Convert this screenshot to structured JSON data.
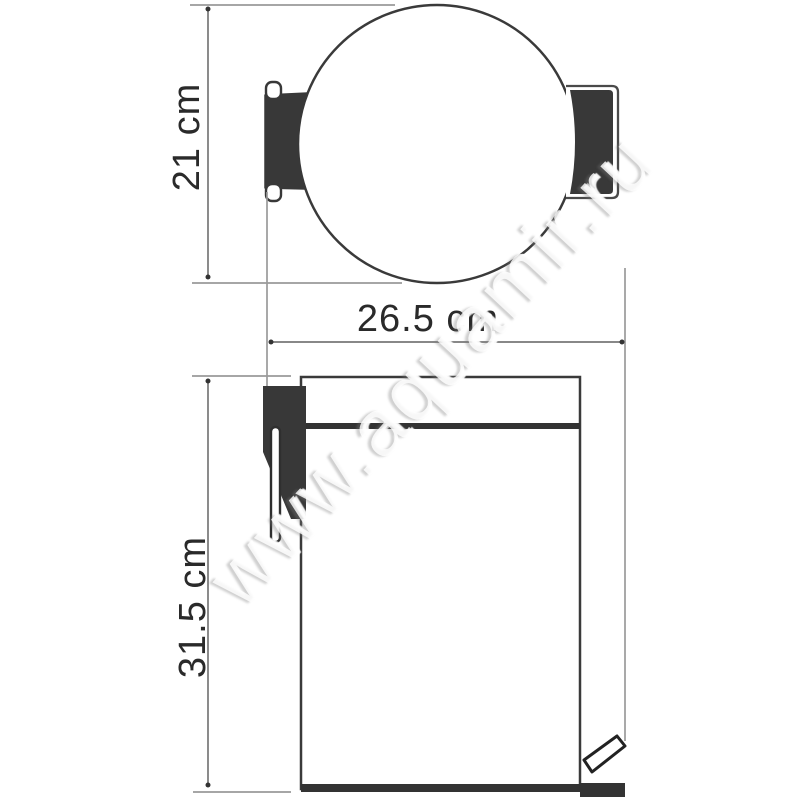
{
  "page": {
    "background": "#ffffff",
    "description": "technical dimension drawing of a pedal waste bin, top view and front view"
  },
  "views": {
    "top_view": {
      "dimension_height": {
        "label": "21 cm"
      }
    },
    "front_view": {
      "dimension_width": {
        "label": "26.5 cm"
      },
      "dimension_height": {
        "label": "31.5 cm"
      }
    }
  },
  "watermark": {
    "text": "www.aquamir.ru"
  },
  "colors": {
    "outline": "#383838",
    "fill_dark": "#383838",
    "dimension_line": "#777777",
    "extension_line": "#9a9a9a",
    "arrow_dot": "#333333",
    "label_text": "#2a2a2a"
  }
}
